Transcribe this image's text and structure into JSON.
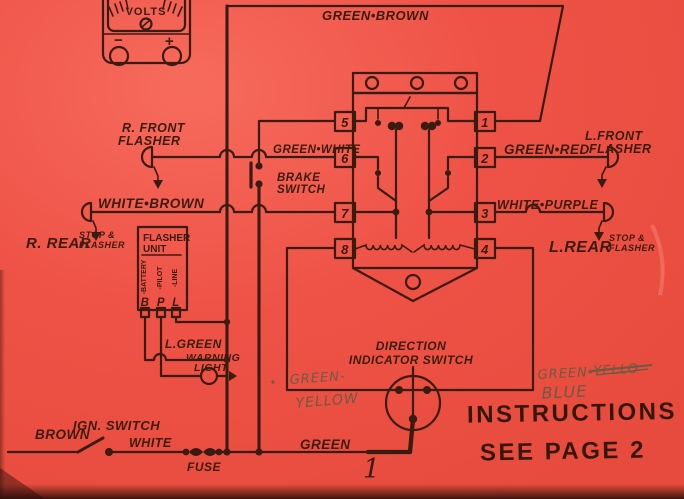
{
  "colors": {
    "paper": "#ef5347",
    "ink": "#3a1b10",
    "pencil": "#6e5a42"
  },
  "meter": {
    "label": "VOLTS",
    "minus": "−",
    "plus": "+"
  },
  "top": {
    "green_brown": "GREEN•BROWN"
  },
  "left": {
    "r_front_1": "R. FRONT",
    "r_front_2": "FLASHER",
    "green_white": "GREEN•WHITE",
    "brake_1": "BRAKE",
    "brake_2": "SWITCH",
    "white_brown": "WHITE•BROWN",
    "r_rear": "R. REAR",
    "r_rear_s1": "STOP &",
    "r_rear_s2": "FLASHER"
  },
  "right": {
    "l_front_1": "L.FRONT",
    "l_front_2": "FLASHER",
    "green_red": "GREEN•RED",
    "white_purple": "WHITE•PURPLE",
    "l_rear": "L.REAR",
    "l_rear_s1": "STOP &",
    "l_rear_s2": "FLASHER"
  },
  "flasher_unit": {
    "t1": "FLASHER",
    "t2": "UNIT",
    "batt": "-BATTERY",
    "pilot": "-PILOT",
    "line": "-LINE",
    "b": "B",
    "p": "P",
    "l": "L"
  },
  "mid": {
    "l_green": "L.GREEN",
    "warning_1": "WARNING",
    "warning_2": "LIGHT",
    "direction_1": "DIRECTION",
    "direction_2": "INDICATOR SWITCH"
  },
  "relay": {
    "left": [
      "5",
      "6",
      "7",
      "8"
    ],
    "right": [
      "1",
      "2",
      "3",
      "4"
    ]
  },
  "bottom": {
    "ign": "IGN. SWITCH",
    "brown": "BROWN",
    "white": "WHITE",
    "fuse": "FUSE",
    "green": "GREEN",
    "marker": "1",
    "instr_1": "INSTRUCTIONS",
    "instr_2": "SEE PAGE 2"
  },
  "handwritten": {
    "left_1": "GREEN-",
    "left_2": "YELLOW",
    "right_1": "GREEN-",
    "right_struck": "YELLO",
    "right_2": "BLUE"
  }
}
